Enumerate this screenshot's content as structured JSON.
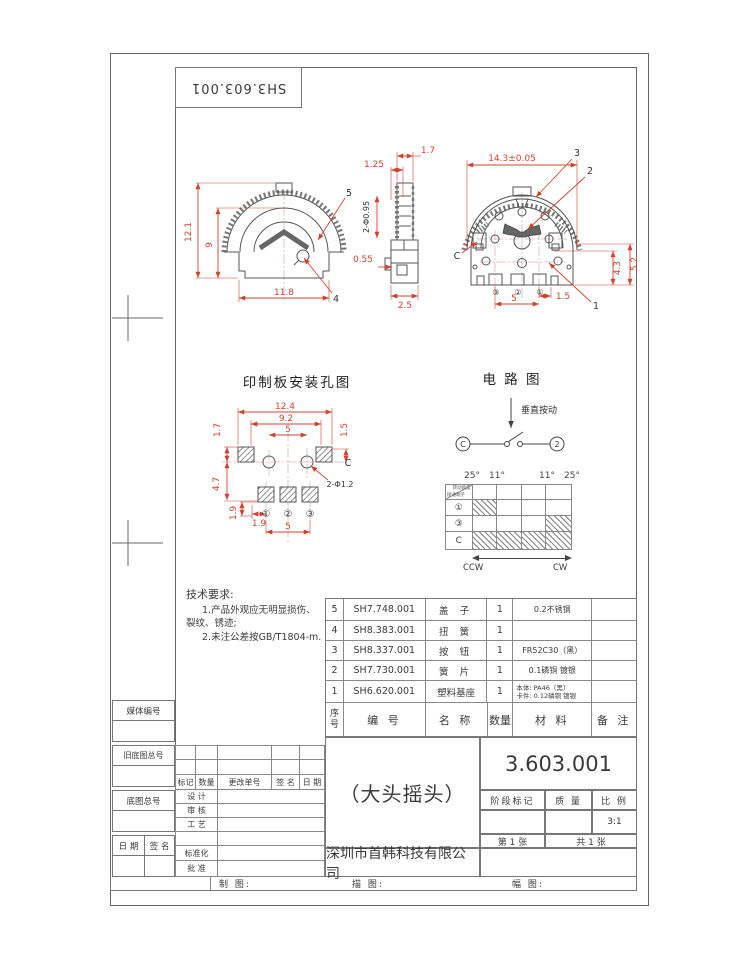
{
  "sheet": {
    "code_top": "SH3.603.001"
  },
  "front_view": {
    "dim_height": "12.1",
    "dim_inner": "9",
    "dim_width": "11.8",
    "label_5": "5",
    "label_4": "4"
  },
  "side_view": {
    "dim_17": "1.7",
    "dim_125": "1.25",
    "dim_holes": "2-Φ0.95",
    "dim_055": "0.55",
    "dim_25": "2.5"
  },
  "rear_view": {
    "dim_width": "14.3±0.05",
    "label_3": "3",
    "label_2": "2",
    "label_1": "1",
    "label_c": "C",
    "dim_52": "5.2",
    "dim_43": "4.3",
    "dim_15": "1.5",
    "dim_5": "5",
    "pin_left": "③",
    "pin_mid": "②",
    "pin_right": "①"
  },
  "pcb": {
    "title": "印制板安装孔图",
    "dim_124": "12.4",
    "dim_92": "9.2",
    "dim_5_top": "5",
    "dim_17": "1.7",
    "dim_15": "1.5",
    "dim_47": "4.7",
    "dim_19v": "1.9",
    "dim_19h": "1.9",
    "dim_5_bottom": "5",
    "hole_label": "2-Φ1.2",
    "c_label": "C",
    "pin_1": "①",
    "pin_2": "②",
    "pin_3": "③"
  },
  "circuit": {
    "title": "电 路 图",
    "action_label": "垂直按动",
    "terminal_left": "C",
    "terminal_right": "2"
  },
  "angle_table": {
    "corner_top": "转动角度",
    "corner_bottom": "接通端子",
    "angles": [
      "25°",
      "11°",
      "11°",
      "25°"
    ],
    "row_labels": [
      "①",
      "③",
      "C"
    ],
    "hatched_cells": {
      "row1": [
        1,
        0,
        0,
        0
      ],
      "row2": [
        0,
        0,
        0,
        1
      ],
      "row3": [
        1,
        1,
        1,
        1
      ]
    },
    "ccw": "CCW",
    "cw": "CW"
  },
  "tech_req": {
    "title": "技术要求:",
    "line1": "1.产品外观应无明显损伤、",
    "line2": "裂纹、锈迹;",
    "line3": "2.未注公差按GB/T1804-m."
  },
  "bom": {
    "headers": {
      "seq": "序号",
      "code": "编 号",
      "name": "名 称",
      "qty": "数量",
      "material": "材 料",
      "remark": "备 注"
    },
    "rows": [
      {
        "seq": "5",
        "code": "SH7.748.001",
        "name": "盖 子",
        "qty": "1",
        "material": "0.2不锈钢",
        "material2": "",
        "remark": ""
      },
      {
        "seq": "4",
        "code": "SH8.383.001",
        "name": "扭 簧",
        "qty": "1",
        "material": "",
        "material2": "",
        "remark": ""
      },
      {
        "seq": "3",
        "code": "SH8.337.001",
        "name": "按 钮",
        "qty": "1",
        "material": "FR52C30（黑）",
        "material2": "",
        "remark": ""
      },
      {
        "seq": "2",
        "code": "SH7.730.001",
        "name": "簧 片",
        "qty": "1",
        "material": "0.1磷铜 镀银",
        "material2": "",
        "remark": ""
      },
      {
        "seq": "1",
        "code": "SH6.620.001",
        "name": "塑料基座",
        "qty": "1",
        "material": "本体: PA46（黑）",
        "material2": "卡件: 0.12磷铜 镀银",
        "remark": ""
      }
    ]
  },
  "title_block": {
    "drawing_number": "3.603.001",
    "part_name": "（大头摇头）",
    "stage_label": "阶段标记",
    "mass_label": "质 量",
    "scale_label": "比 例",
    "scale_value": "3:1",
    "sheet_no": "第 1 张",
    "sheet_total": "共 1 张",
    "company": "深圳市首韩科技有限公司"
  },
  "border": {
    "left": {
      "media": "媒体编号",
      "old_base": "旧底图总号",
      "base": "底图总号",
      "date": "日 期",
      "sign": "签 名"
    },
    "revision": {
      "h1": "标记",
      "h2": "数量",
      "h3": "更改单号",
      "h4": "签 名",
      "h5": "日 期",
      "r1": "设 计",
      "r2": "审 核",
      "r3": "工 艺",
      "r4": "",
      "r5": "标准化",
      "r6": "批 准"
    },
    "bottom": {
      "draw": "制 图:",
      "trace": "描 图:",
      "size": "幅 图:"
    }
  }
}
